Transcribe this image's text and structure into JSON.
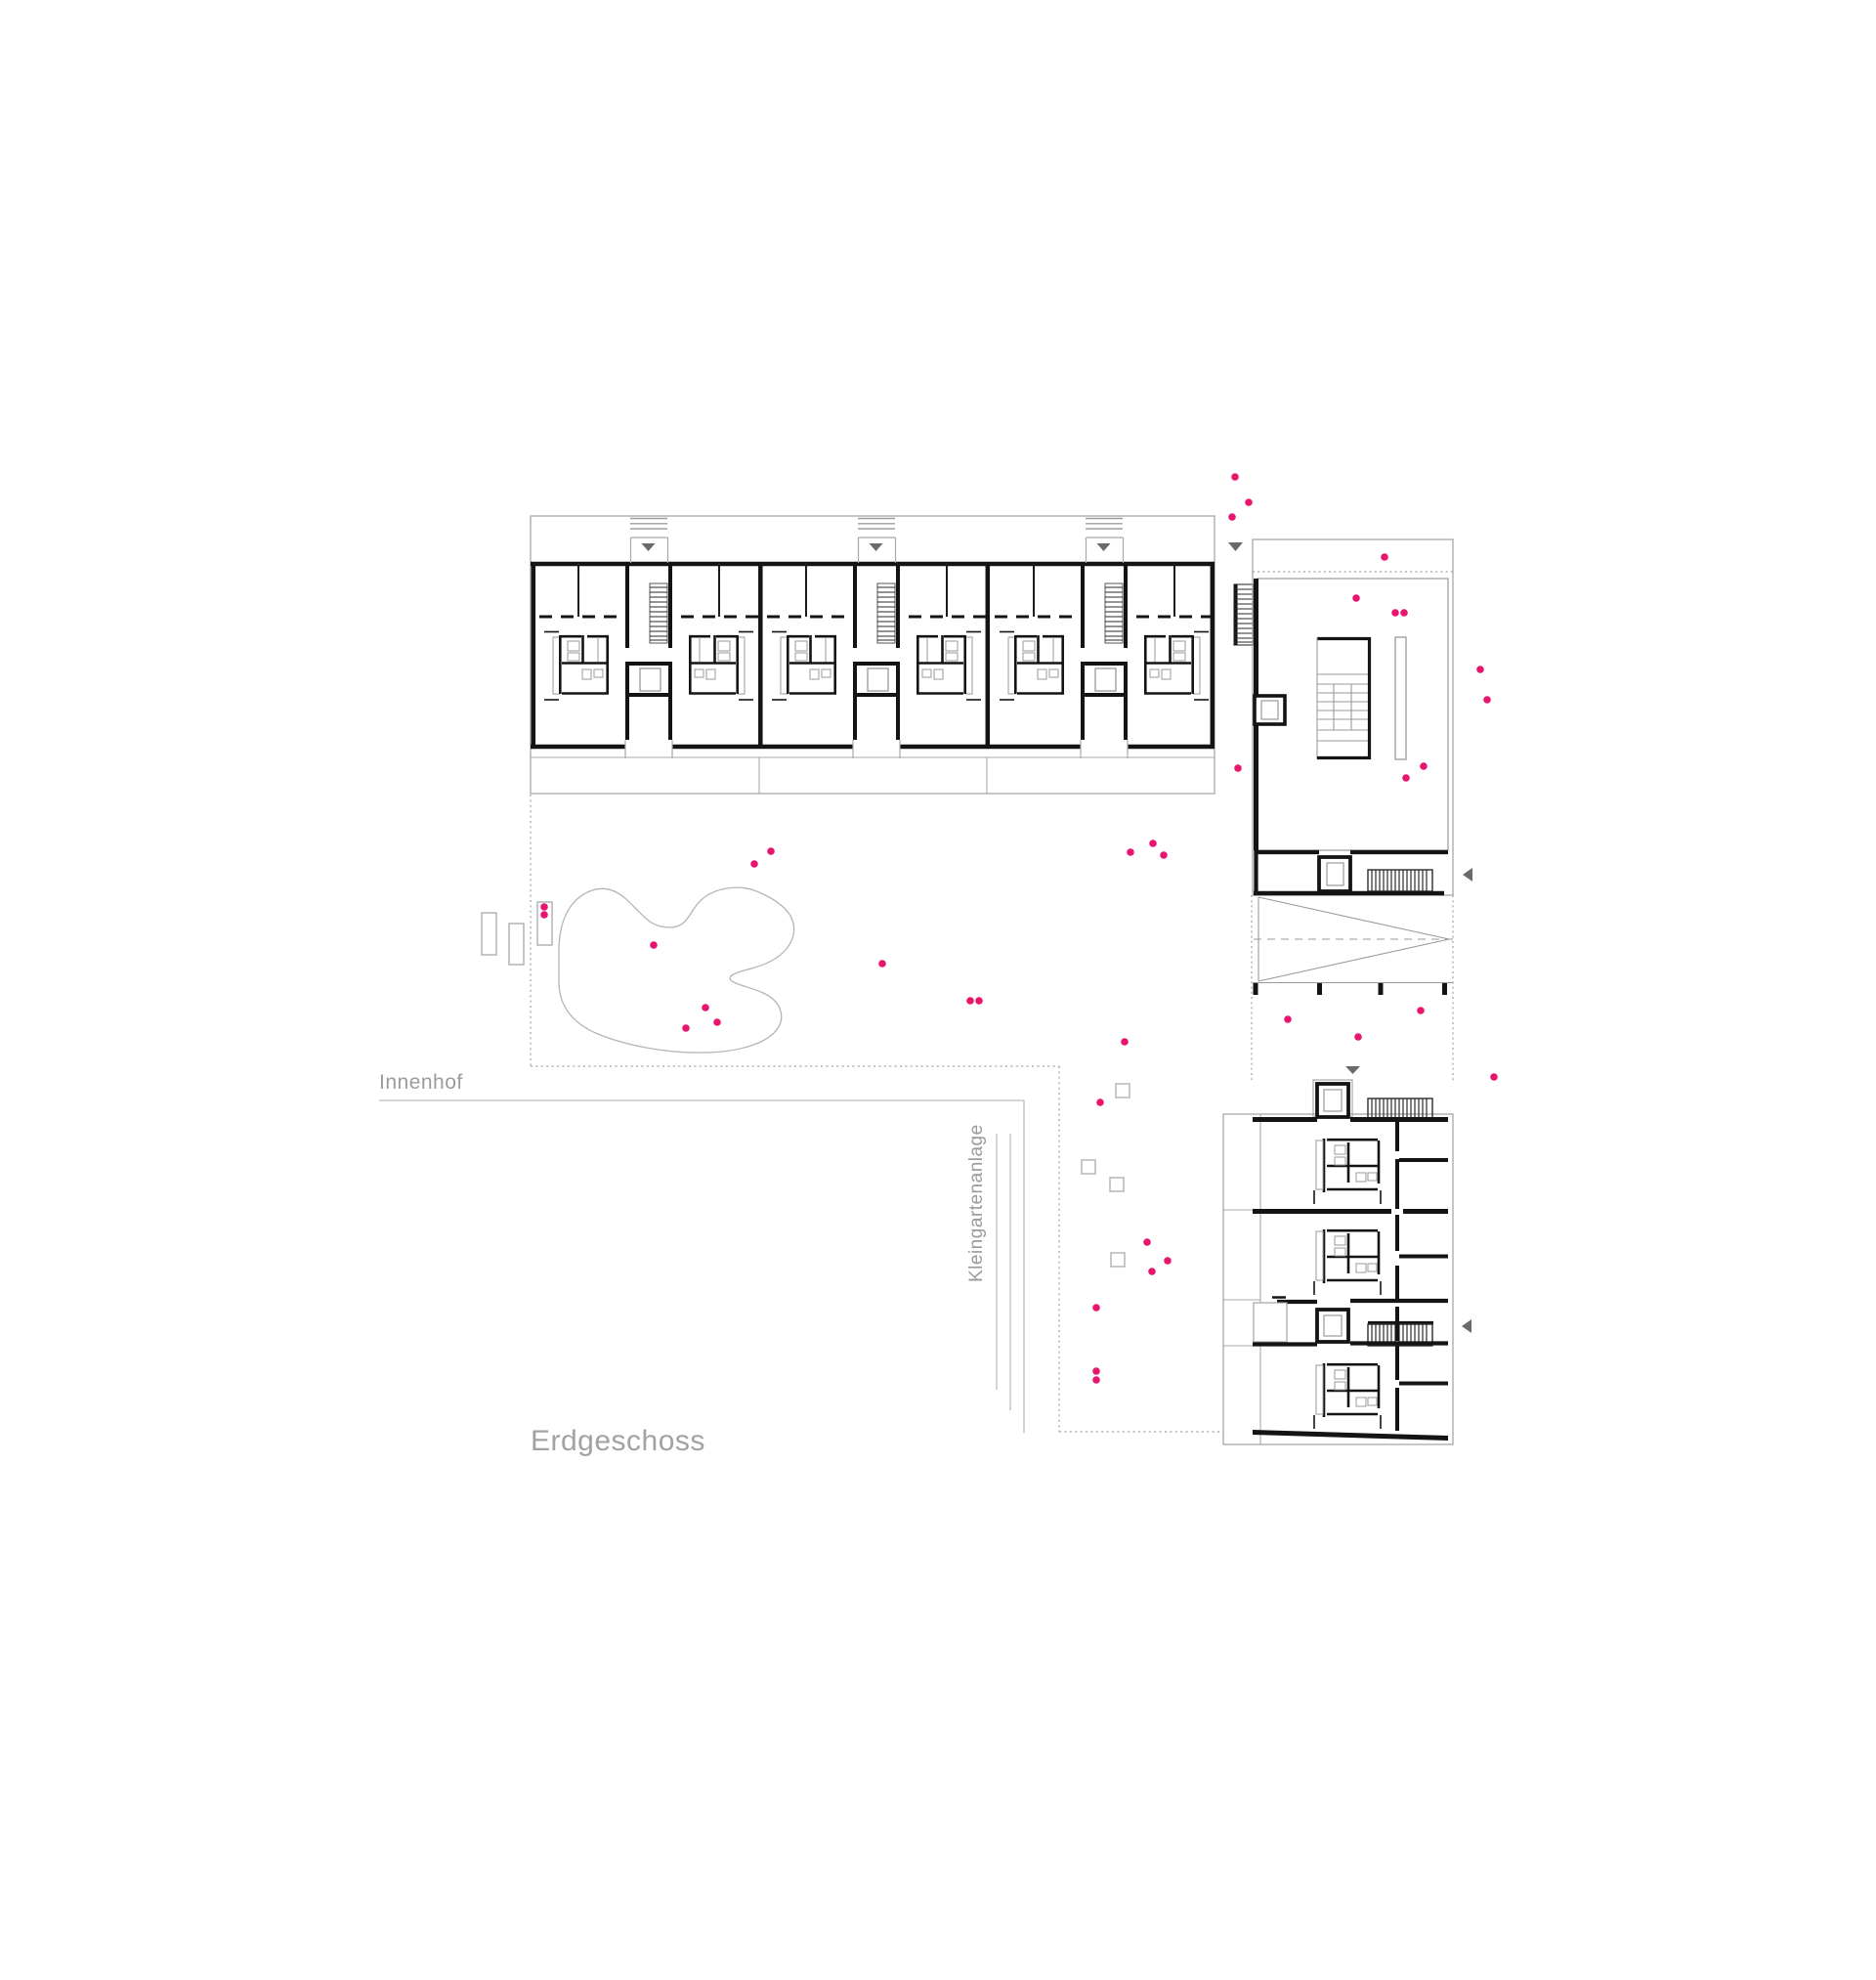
{
  "drawing": {
    "floor_label": "Erdgeschoss",
    "courtyard_label": "Innenhof",
    "allotment_label": "Kleingartenanlage"
  },
  "colors": {
    "wall": "#141414",
    "outline": "#a8a8a8",
    "dotted_boundary": "#a0a0a0",
    "fence": "#bcbcbc",
    "dot": "#e8156f",
    "triangle": "#6a6a6a",
    "label_text": "#9b9b9b"
  },
  "markers": {
    "dot_radius": 3.8,
    "dots": [
      [
        1264,
        488
      ],
      [
        1278,
        514
      ],
      [
        1261,
        529
      ],
      [
        1417,
        570
      ],
      [
        1388,
        612
      ],
      [
        1428,
        627
      ],
      [
        1437,
        627
      ],
      [
        1515,
        685
      ],
      [
        1522,
        716
      ],
      [
        1267,
        786
      ],
      [
        1457,
        784
      ],
      [
        1439,
        796
      ],
      [
        1157,
        872
      ],
      [
        1180,
        863
      ],
      [
        1191,
        875
      ],
      [
        772,
        884
      ],
      [
        789,
        871
      ],
      [
        557,
        928
      ],
      [
        557,
        936
      ],
      [
        669,
        967
      ],
      [
        722,
        1031
      ],
      [
        702,
        1052
      ],
      [
        734,
        1046
      ],
      [
        903,
        986
      ],
      [
        993,
        1024
      ],
      [
        1002,
        1024
      ],
      [
        1151,
        1066
      ],
      [
        1126,
        1128
      ],
      [
        1318,
        1043
      ],
      [
        1390,
        1061
      ],
      [
        1454,
        1034
      ],
      [
        1529,
        1102
      ],
      [
        1174,
        1271
      ],
      [
        1195,
        1290
      ],
      [
        1179,
        1301
      ],
      [
        1122,
        1338
      ],
      [
        1122,
        1403
      ],
      [
        1122,
        1412
      ]
    ],
    "square_size": 14,
    "squares": [
      [
        1142,
        1109
      ],
      [
        1107,
        1187
      ],
      [
        1136,
        1205
      ],
      [
        1137,
        1282
      ]
    ],
    "benches": [
      [
        493,
        934,
        15,
        43
      ],
      [
        521,
        945,
        15,
        42
      ],
      [
        550,
        923,
        15,
        44
      ]
    ]
  }
}
